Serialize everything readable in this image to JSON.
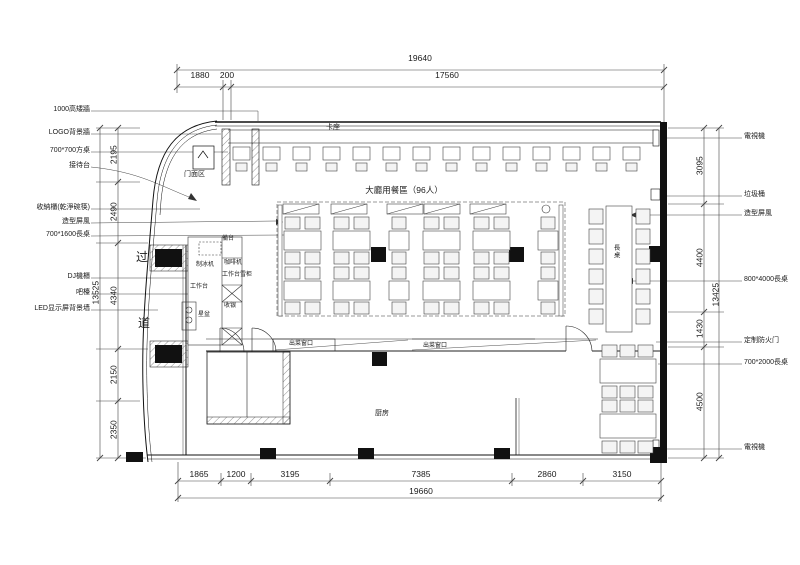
{
  "left_labels": [
    "1000高矮牆",
    "LOGO背景牆",
    "700*700方桌",
    "接待台",
    "收納櫃(乾淨碗筷)",
    "造型屏風",
    "700*1600長桌",
    "DJ機櫃",
    "吧檯",
    "LED显示屏背景墙"
  ],
  "right_labels": [
    "電視機",
    "垃圾桶",
    "造型屏風",
    "800*4000長桌",
    "定制防火门",
    "700*2000長桌",
    "電視機"
  ],
  "plan": {
    "hall": "大廳用餐區（96人）",
    "booth": "卡座",
    "storefront": "门面区",
    "corridor_top": "过",
    "corridor_bottom": "道",
    "kitchen": "厨房",
    "long_table": "長桌",
    "serving_window_1": "出菜窗口",
    "serving_window_2": "出菜窗口",
    "prep_counter": "備台",
    "ice_maker": "制冰机",
    "coffee_machine": "咖啡机",
    "worktable_fridge": "工作台雪柜",
    "worktable": "工作台",
    "cashier": "收银",
    "sink": "星盆"
  },
  "dims": {
    "top": {
      "overall": "19640",
      "seg1": "1880",
      "seg2": "200",
      "seg3": "17560"
    },
    "bottom": {
      "overall": "19660",
      "seg1": "1865",
      "seg2": "1200",
      "seg3": "3195",
      "seg4": "7385",
      "seg5": "2860",
      "seg6": "3150"
    },
    "left": {
      "overall": "13525",
      "seg1": "2195",
      "seg2": "2490",
      "seg3": "4340",
      "seg4": "2150",
      "seg5": "2350"
    },
    "right": {
      "overall": "13425",
      "seg1": "3095",
      "seg2": "4400",
      "seg3": "1430",
      "seg4": "4500"
    }
  }
}
